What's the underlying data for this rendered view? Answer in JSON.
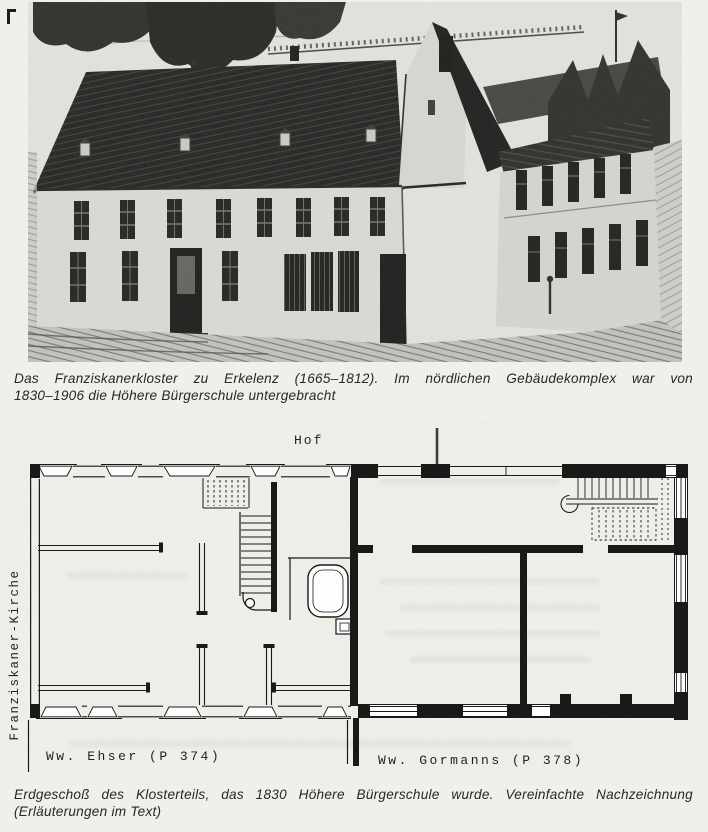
{
  "page": {
    "kind": "scanned book page",
    "colors": {
      "paper": "#f0efea",
      "ink": "#1c1c1a",
      "photo_bg": "#e4e3de",
      "roof_dark": "#232321"
    }
  },
  "photo_caption": {
    "line1": "Das Franziskanerkloster zu Erkelenz (1665–1812). Im nördlichen Gebäudekomplex war von",
    "line2": "1830–1906 die Höhere Bürgerschule untergebracht"
  },
  "floor_plan": {
    "labels": {
      "hof": "Hof",
      "kirche": "Franziskaner-Kirche",
      "ehser": "Ww. Ehser (P 374)",
      "gormanns": "Ww. Gormanns (P 378)"
    }
  },
  "plan_caption": {
    "line1": "Erdgeschoß des Klosterteils, das 1830 Höhere Bürgerschule wurde. Vereinfachte Nachzeichnung",
    "line2": "(Erläuterungen im Text)"
  }
}
